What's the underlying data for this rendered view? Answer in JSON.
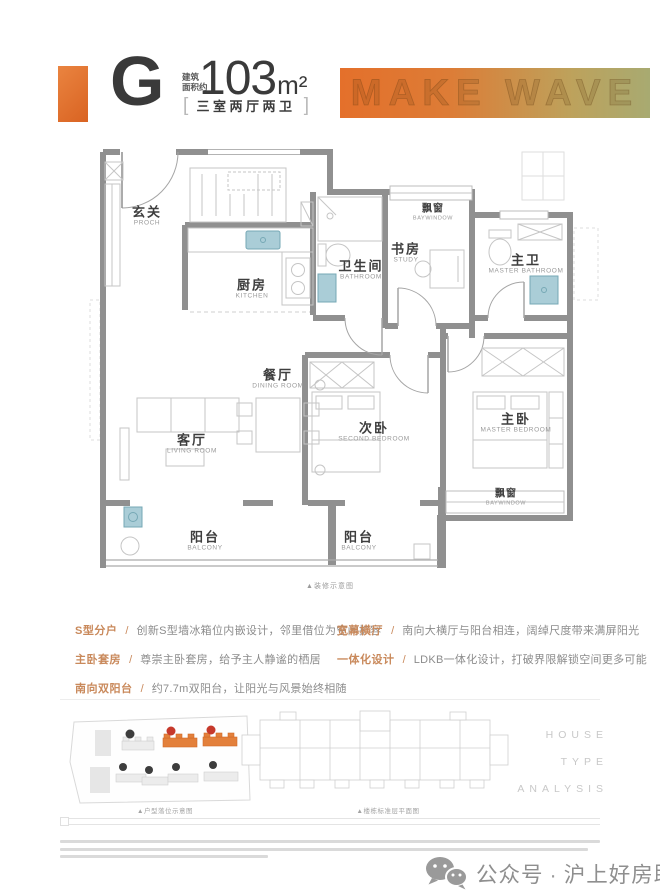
{
  "header": {
    "accent_color": "#e0702c",
    "type_letter": "G",
    "area_prefix_line1": "建筑",
    "area_prefix_line2": "面积约",
    "area_value": "103",
    "area_unit": "m²",
    "bracket_left": "[",
    "bracket_right": "]",
    "layout_label": "三室两厅两卫",
    "watermark": "MAKE WAVE"
  },
  "floorplan": {
    "caption": "▲装修示意图",
    "rooms": [
      {
        "cn": "玄关",
        "en": "PROCH"
      },
      {
        "cn": "厨房",
        "en": "KITCHEN"
      },
      {
        "cn": "卫生间",
        "en": "BATHROOM"
      },
      {
        "cn": "飘窗",
        "en": "BAYWINDOW"
      },
      {
        "cn": "书房",
        "en": "STUDY"
      },
      {
        "cn": "主卫",
        "en": "MASTER BATHROOM"
      },
      {
        "cn": "餐厅",
        "en": "DINING ROOM"
      },
      {
        "cn": "客厅",
        "en": "LIVING ROOM"
      },
      {
        "cn": "次卧",
        "en": "SECOND BEDROOM"
      },
      {
        "cn": "主卧",
        "en": "MASTER BEDROOM"
      },
      {
        "cn": "飘窗",
        "en": "BAYWINDOW"
      },
      {
        "cn": "阳台",
        "en": "BALCONY"
      },
      {
        "cn": "阳台",
        "en": "BALCONY"
      }
    ]
  },
  "features": {
    "separator": "/",
    "left": [
      {
        "label": "S型分户",
        "text": "创新S型墙冰箱位内嵌设计，邻里借位为空间扩容"
      },
      {
        "label": "主卧套房",
        "text": "尊崇主卧套房，给予主人静谧的栖居"
      },
      {
        "label": "南向双阳台",
        "text": "约7.7m双阳台，让阳光与风景始终相随"
      }
    ],
    "right": [
      {
        "label": "宽幕横厅",
        "text": "南向大横厅与阳台相连，阔绰尺度带来满屏阳光"
      },
      {
        "label": "一体化设计",
        "text": "LDKB一体化设计，打破界限解锁空间更多可能"
      }
    ]
  },
  "bottom": {
    "site_plan_caption": "▲户型落位示意图",
    "floor_plate_caption": "▲楼栋标准层平面图",
    "analysis_lines": [
      "HOUSE",
      "TYPE",
      "ANALYSIS"
    ]
  },
  "footer": {
    "account_label": "公众号",
    "separator": "·",
    "account_name": "沪上好房助手"
  }
}
